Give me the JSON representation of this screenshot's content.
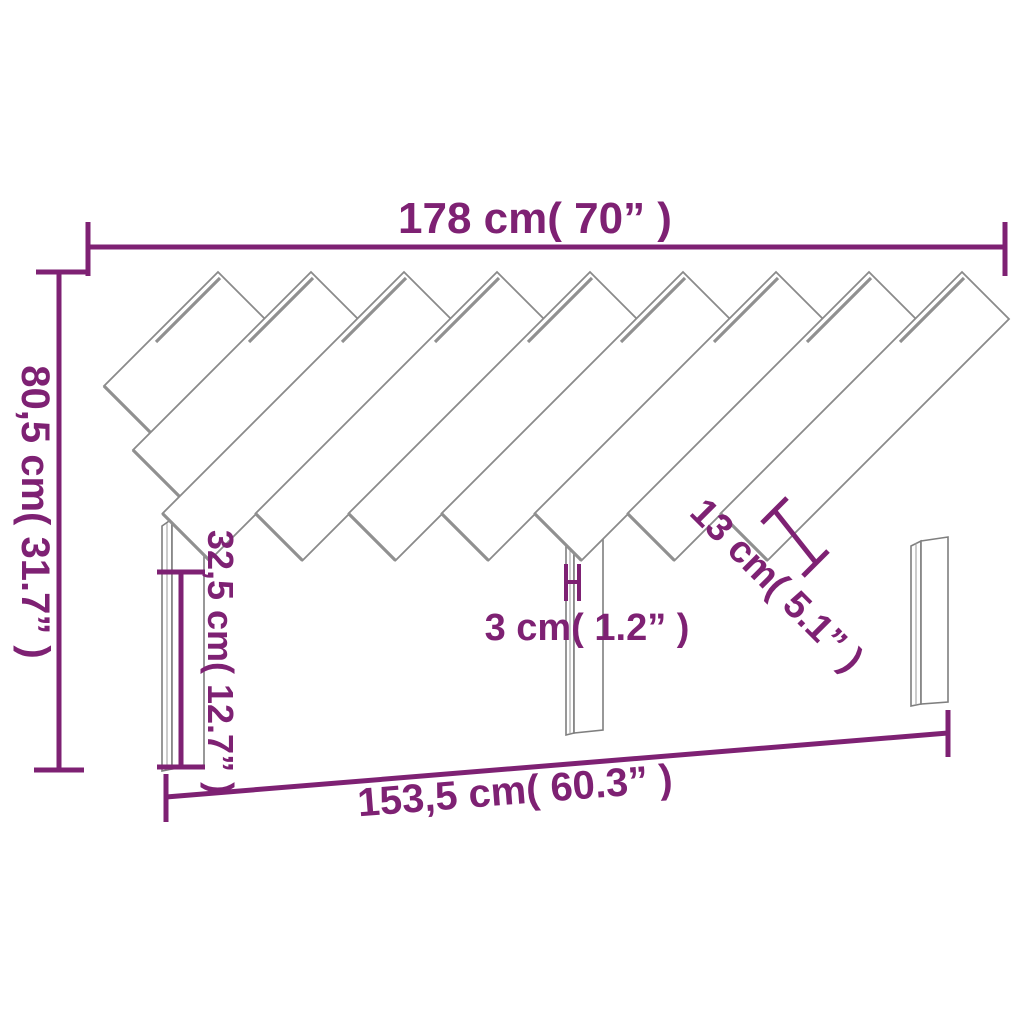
{
  "title": "Headboard with diagonal slats - dimension diagram",
  "dimensions": {
    "top_width": {
      "label": "178 cm( 70” )"
    },
    "left_height": {
      "label": "80,5 cm( 31.7” )"
    },
    "leg_height": {
      "label": "32,5 cm( 12.7” )"
    },
    "board_thickness": {
      "label": "3 cm( 1.2” )"
    },
    "slat_width": {
      "label": "13 cm( 5.1” )"
    },
    "bottom_width": {
      "label": "153,5 cm( 60.3” )"
    }
  },
  "colors": {
    "dimension_color": "#7E2173",
    "outline_color": "#8A8A8A",
    "background": "#FFFFFF"
  }
}
